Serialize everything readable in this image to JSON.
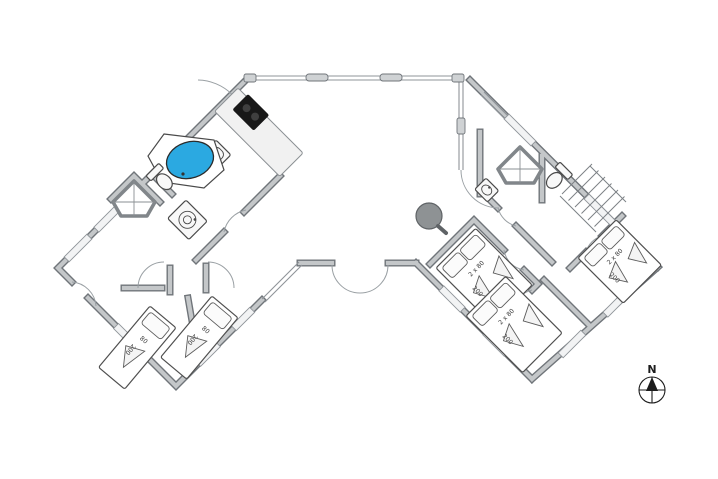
{
  "colors": {
    "hot_tub": "#2BA9E1",
    "stove": "#181818",
    "stove_burner": "#3f3f3f",
    "tree": "#8e9294",
    "wall_core": "#c4c7c9",
    "wall_edge": "#70757a",
    "glass": "#8f9499",
    "label_text": "#3a3a3a",
    "compass": "#1c1c1c"
  },
  "beds": [
    {
      "room": "left-wing-bedroom-1",
      "type": "single",
      "width_label": "80",
      "length_label": "200"
    },
    {
      "room": "left-wing-bedroom-2",
      "type": "single",
      "width_label": "80",
      "length_label": "200"
    },
    {
      "room": "right-wing-bedroom-north",
      "type": "double",
      "width_label": "2 x 80",
      "length_label": "200"
    },
    {
      "room": "right-wing-bedroom-south",
      "type": "double",
      "width_label": "2 x 80",
      "length_label": "200"
    },
    {
      "room": "right-wing-bedroom-east",
      "type": "double",
      "width_label": "2 x 80",
      "length_label": "200"
    }
  ],
  "compass": {
    "north_label": "N"
  },
  "fixtures": [
    "hot-tub",
    "stove",
    "kitchen-sink",
    "toilet",
    "shower-cabin",
    "washing-machine",
    "washbasin",
    "staircase",
    "tree",
    "compass-rose"
  ]
}
